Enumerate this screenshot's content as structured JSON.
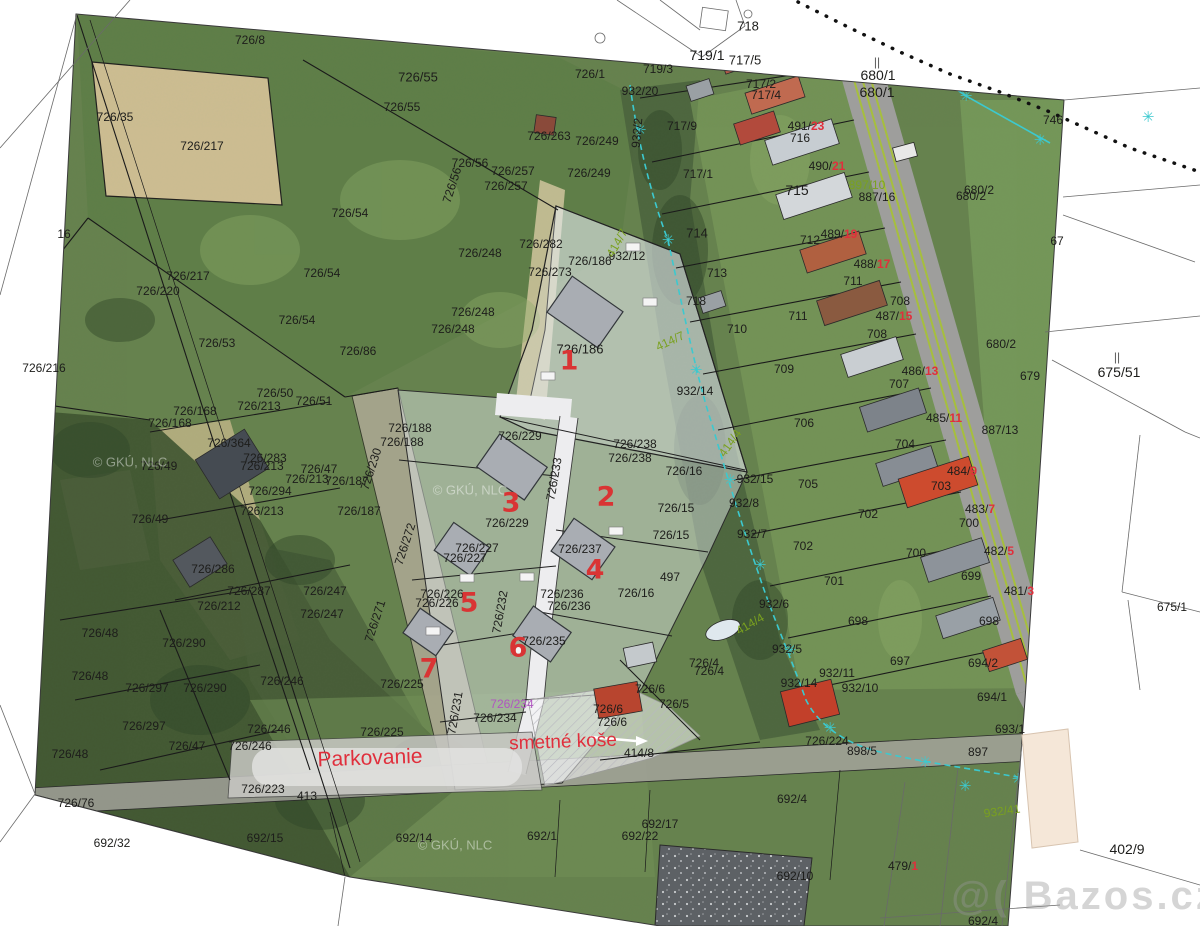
{
  "map": {
    "colors": {
      "black": "#1d1d1b",
      "red": "#e02f3c",
      "green": "#7aa11f",
      "magenta": "#b055c0",
      "gray": "#5a5a5a",
      "faint": "rgba(255,255,255,0.55)",
      "wm": "rgba(150,150,150,0.5)",
      "plotred": "#d93434"
    },
    "plot_numbers": [
      {
        "t": "1",
        "x": 569,
        "y": 361
      },
      {
        "t": "2",
        "x": 606,
        "y": 497
      },
      {
        "t": "3",
        "x": 511,
        "y": 503
      },
      {
        "t": "4",
        "x": 595,
        "y": 570
      },
      {
        "t": "5",
        "x": 469,
        "y": 603
      },
      {
        "t": "6",
        "x": 518,
        "y": 648
      },
      {
        "t": "7",
        "x": 429,
        "y": 669
      }
    ],
    "labels": [
      {
        "t": "726/8",
        "x": 250,
        "y": 40
      },
      {
        "t": "726/35",
        "x": 115,
        "y": 117
      },
      {
        "t": "726/55",
        "x": 418,
        "y": 77,
        "s": 13
      },
      {
        "t": "726/55",
        "x": 402,
        "y": 107
      },
      {
        "t": "726/217",
        "x": 202,
        "y": 146
      },
      {
        "t": "726/217",
        "x": 188,
        "y": 276
      },
      {
        "t": "726/220",
        "x": 158,
        "y": 291
      },
      {
        "t": "726/216",
        "x": 44,
        "y": 368
      },
      {
        "t": "16",
        "x": 64,
        "y": 234
      },
      {
        "t": "726/54",
        "x": 350,
        "y": 213
      },
      {
        "t": "726/54",
        "x": 322,
        "y": 273
      },
      {
        "t": "726/54",
        "x": 297,
        "y": 320
      },
      {
        "t": "726/56",
        "x": 470,
        "y": 163
      },
      {
        "t": "726/56",
        "x": 452,
        "y": 185,
        "r": -72
      },
      {
        "t": "726/257",
        "x": 513,
        "y": 171
      },
      {
        "t": "726/257",
        "x": 506,
        "y": 186
      },
      {
        "t": "726/263",
        "x": 549,
        "y": 136
      },
      {
        "t": "726/249",
        "x": 597,
        "y": 141
      },
      {
        "t": "726/249",
        "x": 589,
        "y": 173
      },
      {
        "t": "726/248",
        "x": 480,
        "y": 253
      },
      {
        "t": "726/248",
        "x": 473,
        "y": 312
      },
      {
        "t": "726/248",
        "x": 453,
        "y": 329
      },
      {
        "t": "726/282",
        "x": 541,
        "y": 244
      },
      {
        "t": "726/273",
        "x": 550,
        "y": 272
      },
      {
        "t": "726/186",
        "x": 590,
        "y": 261
      },
      {
        "t": "726/186",
        "x": 580,
        "y": 349,
        "s": 13
      },
      {
        "t": "726/86",
        "x": 358,
        "y": 351
      },
      {
        "t": "726/188",
        "x": 410,
        "y": 428
      },
      {
        "t": "726/188",
        "x": 402,
        "y": 442
      },
      {
        "t": "726/1",
        "x": 590,
        "y": 74
      },
      {
        "t": "932/20",
        "x": 640,
        "y": 91
      },
      {
        "t": "932/2",
        "x": 637,
        "y": 133,
        "r": -85
      },
      {
        "t": "718",
        "x": 748,
        "y": 26,
        "s": 13
      },
      {
        "t": "719/1",
        "x": 707,
        "y": 55,
        "s": 14
      },
      {
        "t": "717/5",
        "x": 745,
        "y": 60,
        "s": 13
      },
      {
        "t": "719/3",
        "x": 658,
        "y": 69
      },
      {
        "t": "717/2",
        "x": 761,
        "y": 84
      },
      {
        "t": "717/4",
        "x": 766,
        "y": 95
      },
      {
        "t": "680/1",
        "x": 878,
        "y": 75,
        "s": 14
      },
      {
        "t": "680/1",
        "x": 877,
        "y": 92,
        "s": 14
      },
      {
        "t": "||",
        "x": 877,
        "y": 62,
        "c": "gray"
      },
      {
        "t": "717/9",
        "x": 682,
        "y": 126
      },
      {
        "t": "717/1",
        "x": 698,
        "y": 174
      },
      {
        "t": "716",
        "x": 800,
        "y": 138
      },
      {
        "t": "715",
        "x": 797,
        "y": 190,
        "s": 14
      },
      {
        "t": "714",
        "x": 697,
        "y": 233,
        "s": 13
      },
      {
        "t": "713",
        "x": 717,
        "y": 273
      },
      {
        "t": "712",
        "x": 810,
        "y": 240
      },
      {
        "t": "711",
        "x": 853,
        "y": 281
      },
      {
        "t": "711",
        "x": 798,
        "y": 316
      },
      {
        "t": "710",
        "x": 737,
        "y": 329
      },
      {
        "t": "709",
        "x": 784,
        "y": 369
      },
      {
        "t": "708",
        "x": 900,
        "y": 301
      },
      {
        "t": "708",
        "x": 877,
        "y": 334
      },
      {
        "t": "707",
        "x": 899,
        "y": 384
      },
      {
        "t": "706",
        "x": 804,
        "y": 423
      },
      {
        "t": "705",
        "x": 808,
        "y": 484
      },
      {
        "t": "704",
        "x": 905,
        "y": 444
      },
      {
        "t": "703",
        "x": 941,
        "y": 486
      },
      {
        "t": "702",
        "x": 868,
        "y": 514
      },
      {
        "t": "702",
        "x": 803,
        "y": 546
      },
      {
        "t": "701",
        "x": 834,
        "y": 581
      },
      {
        "t": "700",
        "x": 969,
        "y": 523
      },
      {
        "t": "700",
        "x": 916,
        "y": 553
      },
      {
        "t": "699",
        "x": 971,
        "y": 576
      },
      {
        "t": "698",
        "x": 989,
        "y": 621
      },
      {
        "t": "698",
        "x": 858,
        "y": 621
      },
      {
        "t": "697",
        "x": 900,
        "y": 661
      },
      {
        "t": "718",
        "x": 696,
        "y": 301
      },
      {
        "t": "746",
        "x": 1053,
        "y": 120
      },
      {
        "t": "680/2",
        "x": 979,
        "y": 190
      },
      {
        "t": "680/2",
        "x": 971,
        "y": 196
      },
      {
        "t": "680/2",
        "x": 1001,
        "y": 344
      },
      {
        "t": "67",
        "x": 1057,
        "y": 241
      },
      {
        "t": "679",
        "x": 1030,
        "y": 376
      },
      {
        "t": "675/51",
        "x": 1119,
        "y": 372,
        "s": 14
      },
      {
        "t": "||",
        "x": 1117,
        "y": 357,
        "c": "gray"
      },
      {
        "t": "675/1",
        "x": 1172,
        "y": 607
      },
      {
        "t": "887/16",
        "x": 877,
        "y": 197
      },
      {
        "t": "887/13",
        "x": 1000,
        "y": 430
      },
      {
        "t": "932/12",
        "x": 627,
        "y": 256
      },
      {
        "t": "932/14",
        "x": 695,
        "y": 391
      },
      {
        "t": "932/15",
        "x": 755,
        "y": 479
      },
      {
        "t": "932/8",
        "x": 744,
        "y": 503
      },
      {
        "t": "932/7",
        "x": 752,
        "y": 534
      },
      {
        "t": "932/6",
        "x": 774,
        "y": 604
      },
      {
        "t": "932/5",
        "x": 787,
        "y": 649
      },
      {
        "t": "932/11",
        "x": 837,
        "y": 673
      },
      {
        "t": "932/14",
        "x": 799,
        "y": 683
      },
      {
        "t": "932/10",
        "x": 860,
        "y": 688
      },
      {
        "t": "726/16",
        "x": 684,
        "y": 471
      },
      {
        "t": "726/15",
        "x": 676,
        "y": 508
      },
      {
        "t": "726/15",
        "x": 671,
        "y": 535
      },
      {
        "t": "497",
        "x": 670,
        "y": 577
      },
      {
        "t": "726/16",
        "x": 636,
        "y": 593
      },
      {
        "t": "726/4",
        "x": 704,
        "y": 663
      },
      {
        "t": "726/4",
        "x": 709,
        "y": 671
      },
      {
        "t": "726/5",
        "x": 674,
        "y": 704
      },
      {
        "t": "726/6",
        "x": 650,
        "y": 689
      },
      {
        "t": "726/6",
        "x": 608,
        "y": 709
      },
      {
        "t": "726/6",
        "x": 612,
        "y": 722
      },
      {
        "t": "726/238",
        "x": 635,
        "y": 444
      },
      {
        "t": "726/238",
        "x": 630,
        "y": 458
      },
      {
        "t": "726/229",
        "x": 520,
        "y": 436
      },
      {
        "t": "726/229",
        "x": 507,
        "y": 523
      },
      {
        "t": "726/227",
        "x": 477,
        "y": 548
      },
      {
        "t": "726/227",
        "x": 465,
        "y": 558
      },
      {
        "t": "726/237",
        "x": 580,
        "y": 549
      },
      {
        "t": "726/226",
        "x": 442,
        "y": 594
      },
      {
        "t": "726/226",
        "x": 437,
        "y": 603
      },
      {
        "t": "726/236",
        "x": 562,
        "y": 594
      },
      {
        "t": "726/236",
        "x": 569,
        "y": 606
      },
      {
        "t": "726/235",
        "x": 544,
        "y": 641
      },
      {
        "t": "726/234",
        "x": 495,
        "y": 718
      },
      {
        "t": "726/234",
        "x": 512,
        "y": 704,
        "c": "magenta"
      },
      {
        "t": "726/225",
        "x": 402,
        "y": 684
      },
      {
        "t": "726/225",
        "x": 382,
        "y": 732
      },
      {
        "t": "726/223",
        "x": 263,
        "y": 789
      },
      {
        "t": "413",
        "x": 307,
        "y": 796
      },
      {
        "t": "414/8",
        "x": 639,
        "y": 753
      },
      {
        "t": "726/224",
        "x": 827,
        "y": 741
      },
      {
        "t": "898/5",
        "x": 862,
        "y": 751
      },
      {
        "t": "897",
        "x": 978,
        "y": 752
      },
      {
        "t": "692/4",
        "x": 792,
        "y": 799
      },
      {
        "t": "692/4",
        "x": 983,
        "y": 921
      },
      {
        "t": "692/32",
        "x": 112,
        "y": 843
      },
      {
        "t": "692/15",
        "x": 265,
        "y": 838
      },
      {
        "t": "692/14",
        "x": 414,
        "y": 838
      },
      {
        "t": "692/1",
        "x": 542,
        "y": 836
      },
      {
        "t": "692/22",
        "x": 640,
        "y": 836
      },
      {
        "t": "692/17",
        "x": 660,
        "y": 824
      },
      {
        "t": "692/10",
        "x": 795,
        "y": 876
      },
      {
        "t": "693/1",
        "x": 1010,
        "y": 729
      },
      {
        "t": "694/1",
        "x": 992,
        "y": 697
      },
      {
        "t": "694/2",
        "x": 983,
        "y": 663
      },
      {
        "t": "402/9",
        "x": 1127,
        "y": 849,
        "s": 14
      },
      {
        "t": "726/168",
        "x": 195,
        "y": 411
      },
      {
        "t": "726/168",
        "x": 170,
        "y": 423
      },
      {
        "t": "726/364",
        "x": 229,
        "y": 443
      },
      {
        "t": "726/213",
        "x": 259,
        "y": 406
      },
      {
        "t": "726/213",
        "x": 262,
        "y": 466
      },
      {
        "t": "726/213",
        "x": 262,
        "y": 511
      },
      {
        "t": "726/213",
        "x": 307,
        "y": 479
      },
      {
        "t": "726/50",
        "x": 275,
        "y": 393
      },
      {
        "t": "726/51",
        "x": 314,
        "y": 401
      },
      {
        "t": "726/53",
        "x": 217,
        "y": 343
      },
      {
        "t": "726/283",
        "x": 265,
        "y": 458
      },
      {
        "t": "726/294",
        "x": 270,
        "y": 491
      },
      {
        "t": "726/49",
        "x": 159,
        "y": 466
      },
      {
        "t": "726/49",
        "x": 150,
        "y": 519
      },
      {
        "t": "726/47",
        "x": 319,
        "y": 469
      },
      {
        "t": "726/47",
        "x": 187,
        "y": 746
      },
      {
        "t": "726/187",
        "x": 347,
        "y": 481
      },
      {
        "t": "726/187",
        "x": 359,
        "y": 511
      },
      {
        "t": "726/286",
        "x": 213,
        "y": 569
      },
      {
        "t": "726/287",
        "x": 249,
        "y": 591
      },
      {
        "t": "726/212",
        "x": 219,
        "y": 606
      },
      {
        "t": "726/247",
        "x": 325,
        "y": 591
      },
      {
        "t": "726/247",
        "x": 322,
        "y": 614
      },
      {
        "t": "726/290",
        "x": 184,
        "y": 643
      },
      {
        "t": "726/290",
        "x": 205,
        "y": 688
      },
      {
        "t": "726/297",
        "x": 147,
        "y": 688
      },
      {
        "t": "726/297",
        "x": 144,
        "y": 726
      },
      {
        "t": "726/48",
        "x": 100,
        "y": 633
      },
      {
        "t": "726/48",
        "x": 90,
        "y": 676
      },
      {
        "t": "726/48",
        "x": 70,
        "y": 754
      },
      {
        "t": "726/246",
        "x": 282,
        "y": 681
      },
      {
        "t": "726/246",
        "x": 269,
        "y": 729
      },
      {
        "t": "726/246",
        "x": 250,
        "y": 746
      },
      {
        "t": "726/76",
        "x": 76,
        "y": 803
      },
      {
        "t": "726/272",
        "x": 405,
        "y": 544,
        "r": -72
      },
      {
        "t": "726/271",
        "x": 375,
        "y": 621,
        "r": -72
      },
      {
        "t": "726/233",
        "x": 554,
        "y": 479,
        "r": -80
      },
      {
        "t": "726/232",
        "x": 500,
        "y": 612,
        "r": -80
      },
      {
        "t": "726/231",
        "x": 455,
        "y": 713,
        "r": -80
      },
      {
        "t": "726/230",
        "x": 371,
        "y": 469,
        "r": -72
      },
      {
        "t": "897/10",
        "x": 867,
        "y": 185,
        "c": "green"
      },
      {
        "t": "414/7",
        "x": 617,
        "y": 243,
        "c": "green",
        "r": -60
      },
      {
        "t": "414/7",
        "x": 670,
        "y": 341,
        "c": "green",
        "r": -25
      },
      {
        "t": "414/4",
        "x": 730,
        "y": 443,
        "c": "green",
        "r": -55
      },
      {
        "t": "414/4",
        "x": 750,
        "y": 624,
        "c": "green",
        "r": -30
      },
      {
        "t": "932/41",
        "x": 1002,
        "y": 811,
        "c": "green",
        "r": -8
      },
      {
        "t": "491/",
        "t2": "23",
        "x": 806,
        "y": 126
      },
      {
        "t": "490/",
        "t2": "21",
        "x": 827,
        "y": 166
      },
      {
        "t": "489/",
        "t2": "19",
        "x": 839,
        "y": 234
      },
      {
        "t": "488/",
        "t2": "17",
        "x": 872,
        "y": 264
      },
      {
        "t": "487/",
        "t2": "15",
        "x": 894,
        "y": 316
      },
      {
        "t": "486/",
        "t2": "13",
        "x": 920,
        "y": 371
      },
      {
        "t": "485/",
        "t2": "11",
        "x": 944,
        "y": 418
      },
      {
        "t": "484/",
        "t2": "9",
        "x": 962,
        "y": 471
      },
      {
        "t": "483/",
        "t2": "7",
        "x": 980,
        "y": 509
      },
      {
        "t": "482/",
        "t2": "5",
        "x": 999,
        "y": 551
      },
      {
        "t": "481/",
        "t2": "3",
        "x": 1019,
        "y": 591
      },
      {
        "t": "479/",
        "t2": "1",
        "x": 903,
        "y": 866
      },
      {
        "t": "© GKÚ, NLC",
        "x": 130,
        "y": 462,
        "c": "faint",
        "s": 13,
        "n": "gku-watermark",
        "k": "gku"
      },
      {
        "t": "© GKÚ, NLC",
        "x": 470,
        "y": 490,
        "c": "faint",
        "s": 13,
        "n": "gku-watermark",
        "k": "gku"
      },
      {
        "t": "© GKÚ, NLC",
        "x": 455,
        "y": 845,
        "c": "faint",
        "s": 13,
        "n": "gku-watermark",
        "k": "gku"
      },
      {
        "t": "Parkovanie",
        "x": 370,
        "y": 758,
        "c": "red",
        "s": 21,
        "n": "parkovanie-label",
        "r": -2
      },
      {
        "t": "smetné koše",
        "x": 563,
        "y": 742,
        "c": "red",
        "s": 19,
        "n": "smetne-kose-label",
        "r": -2
      },
      {
        "t": "@( Bazos.cz",
        "x": 1085,
        "y": 896,
        "c": "wm",
        "s": 40,
        "n": "bazos-watermark",
        "k": "bazos"
      }
    ]
  }
}
